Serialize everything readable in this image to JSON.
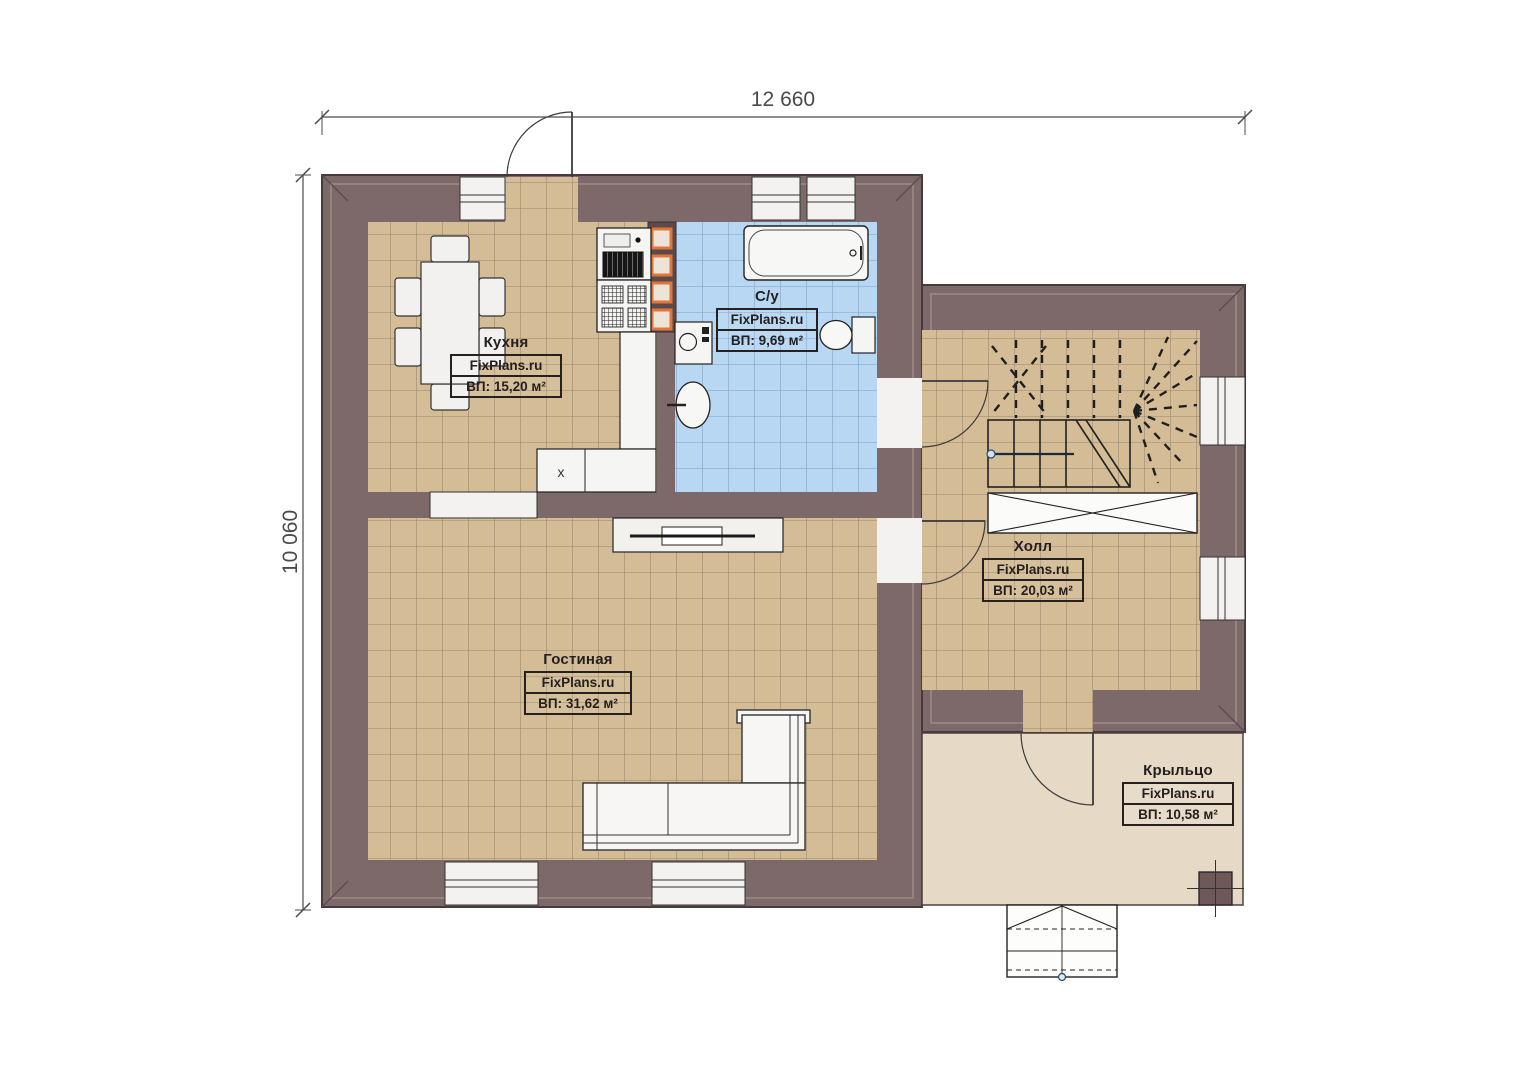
{
  "dims": {
    "width": "12 660",
    "height": "10 060"
  },
  "rooms": [
    {
      "id": "kitchen",
      "name": "Кухня",
      "brand": "FixPlans.ru",
      "area": "ВП: 15,20 м²"
    },
    {
      "id": "bathroom",
      "name": "С/у",
      "brand": "FixPlans.ru",
      "area": "ВП: 9,69 м²"
    },
    {
      "id": "hall",
      "name": "Холл",
      "brand": "FixPlans.ru",
      "area": "ВП: 20,03 м²"
    },
    {
      "id": "living",
      "name": "Гостиная",
      "brand": "FixPlans.ru",
      "area": "ВП: 31,62 м²"
    },
    {
      "id": "porch",
      "name": "Крыльцо",
      "brand": "FixPlans.ru",
      "area": "ВП: 10,58 м²"
    }
  ],
  "fixtures": {
    "cabinet_mark": "x"
  },
  "colors": {
    "wall": "#7d696a",
    "wall_outline": "#473a3c",
    "floor_tan": "#d4bd96",
    "floor_blue": "#b7d7f3",
    "porch_floor": "#e6dac6",
    "vent_orange": "#e0763a",
    "dimension": "#4a4a4a"
  }
}
